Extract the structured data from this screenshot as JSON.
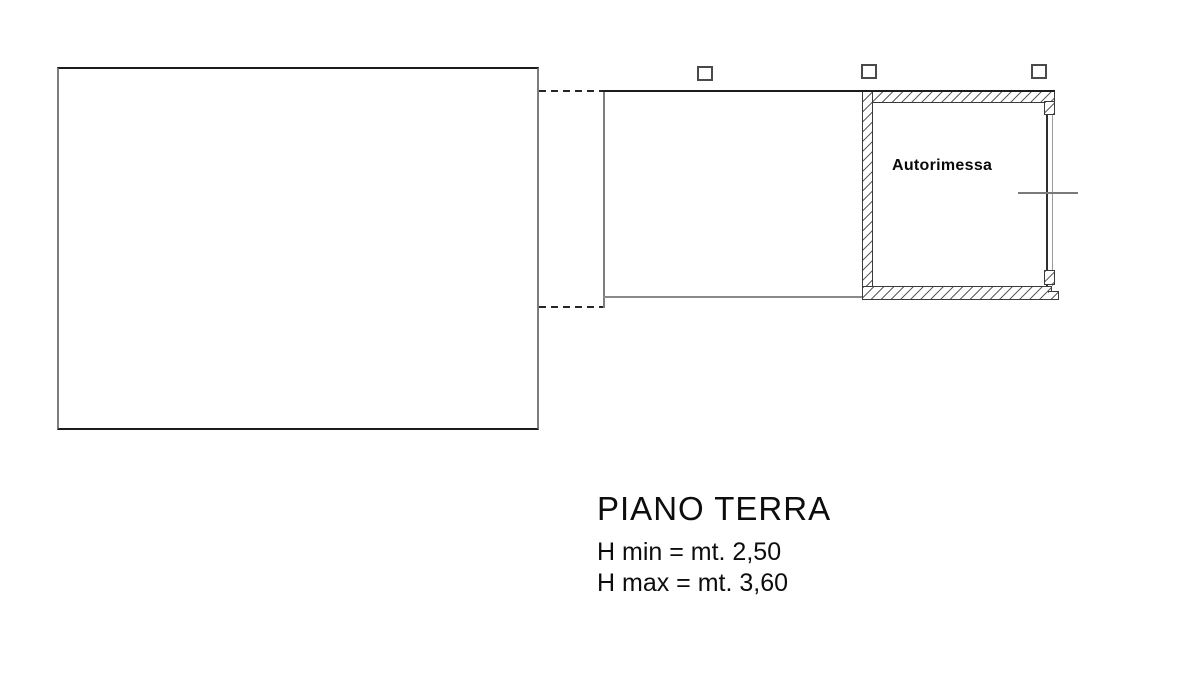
{
  "plan": {
    "room_label": "Autorimessa",
    "floor_title": "PIANO TERRA",
    "h_min": "H min = mt. 2,50",
    "h_max": "H max = mt. 3,60"
  },
  "colors": {
    "background": "#ffffff",
    "line_dark": "#1c1c1c",
    "line_gray": "#7d7d7d",
    "hatch_line": "#5e5e5e",
    "text": "#0d0d0d"
  }
}
